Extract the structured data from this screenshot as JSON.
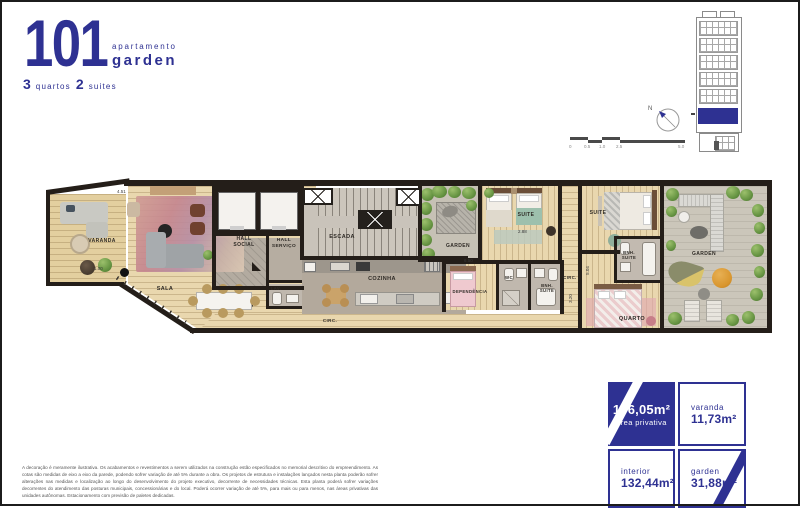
{
  "header": {
    "unit_number": "101",
    "type_label": "apartamento",
    "type_bold": "garden",
    "bedrooms_count": "3",
    "bedrooms_label": "quartos",
    "suites_count": "2",
    "suites_label": "suites"
  },
  "site": {
    "north_label": "N",
    "scale_ticks": [
      "0",
      "0.5",
      "1.0",
      "2.5",
      "5.0"
    ]
  },
  "plan": {
    "rooms": [
      {
        "label": "VARANDA"
      },
      {
        "label": "SALA"
      },
      {
        "label": "HALL\nSOCIAL"
      },
      {
        "label": "HALL\nSERVIÇO"
      },
      {
        "label": "ESCADA"
      },
      {
        "label": "LAV."
      },
      {
        "label": "COZINHA"
      },
      {
        "label": "CIRC."
      },
      {
        "label": "GARDEN"
      },
      {
        "label": "SUITE"
      },
      {
        "label": "DEPENDÊNCIA"
      },
      {
        "label": "WC"
      },
      {
        "label": "BNH.\nSUITE"
      },
      {
        "label": "CIRC."
      },
      {
        "label": "SUITE"
      },
      {
        "label": "BNH.\nSUITE"
      },
      {
        "label": "QUARTO"
      },
      {
        "label": "GARDEN"
      }
    ],
    "dims": [
      "4.51",
      "1.00",
      "6.50",
      "2.88",
      "3.20",
      "5.04"
    ]
  },
  "areas": {
    "privativa": {
      "value": "176,05m²",
      "label": "área privativa"
    },
    "varanda": {
      "label": "varanda",
      "value": "11,73m²"
    },
    "interior": {
      "label": "interior",
      "value": "132,44m²"
    },
    "garden": {
      "label": "garden",
      "value": "31,88m²"
    }
  },
  "disclaimer": "A decoração é meramente ilustrativa. Os acabamentos e revestimentos a serem utilizados na construção estão especificados no memorial descritivo do empreendimento. As cotas são medidas de eixo a eixo da parede, podendo sofrer variação de até 5% durante a obra. Os projetos de estrutura e instalações lançados nesta planta poderão sofrer alterações nas medidas e localização ao longo do desenvolvimento do projeto executivo, decorrente de necessidades técnicas. Esta planta poderá sofrer variações decorrentes do atendimento das posturas municipais, concessionárias e do local. Poderá ocorrer variação de até 5%, para mais ou para menos, nas áreas privativas das unidades autônomas. Estacionamento com previsão de paletes dedicadas.",
  "colors": {
    "brand_navy": "#2e3192",
    "wall": "#241e19",
    "wood": "#e9d7ae",
    "green": "#679543"
  }
}
